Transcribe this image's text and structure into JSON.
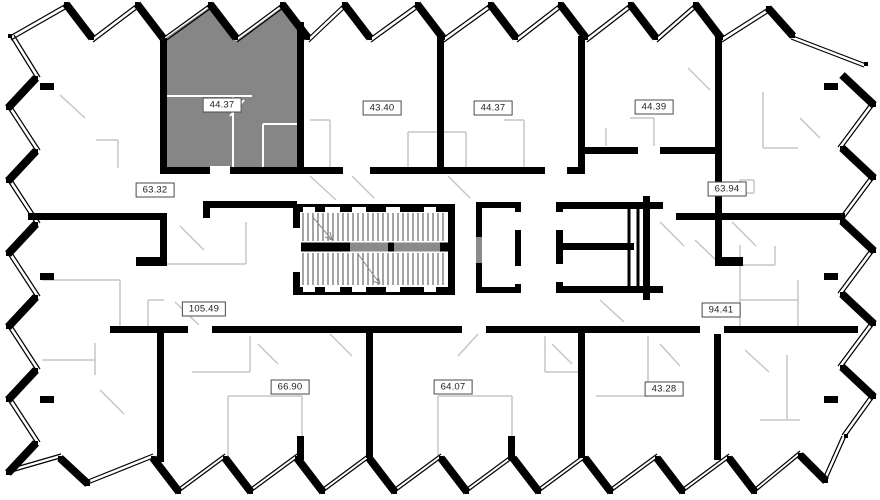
{
  "plan": {
    "units": [
      {
        "area": "44.37",
        "highlighted": true
      },
      {
        "area": "43.40",
        "highlighted": false
      },
      {
        "area": "44.37",
        "highlighted": false
      },
      {
        "area": "44.39",
        "highlighted": false
      },
      {
        "area": "63.32",
        "highlighted": false
      },
      {
        "area": "63.94",
        "highlighted": false
      },
      {
        "area": "105.49",
        "highlighted": false
      },
      {
        "area": "94.41",
        "highlighted": false
      },
      {
        "area": "66.90",
        "highlighted": false
      },
      {
        "area": "64.07",
        "highlighted": false
      },
      {
        "area": "43.28",
        "highlighted": false
      }
    ],
    "colors": {
      "background": "#ffffff",
      "wall": "#000000",
      "partition": "#c6c6c6",
      "highlight": "#868686",
      "label_border": "#4a4a4a",
      "label_text": "#222222"
    }
  }
}
